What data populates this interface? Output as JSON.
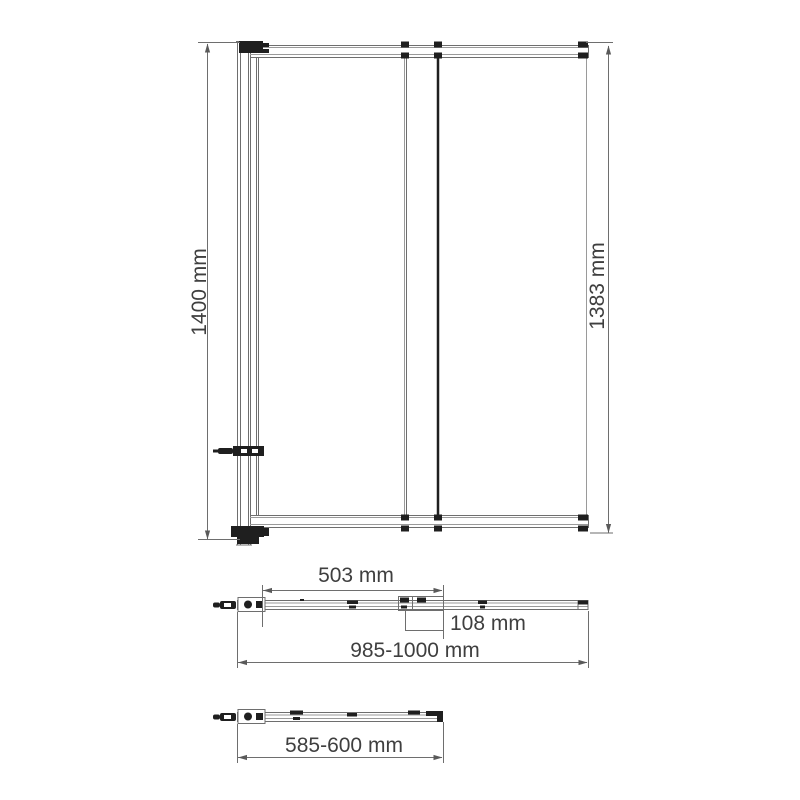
{
  "drawing": {
    "front_view": {
      "height_total_label": "1400 mm",
      "height_glass_label": "1383 mm"
    },
    "top_view": {
      "door_width_label": "503 mm",
      "bracket_depth_label": "108 mm",
      "total_width_label": "985-1000 mm"
    },
    "folded_view": {
      "folded_width_label": "585-600 mm"
    },
    "colors": {
      "background": "#ffffff",
      "line": "#6e6e6e",
      "dark": "#1f1f1f",
      "text": "#3f3f3f"
    }
  }
}
